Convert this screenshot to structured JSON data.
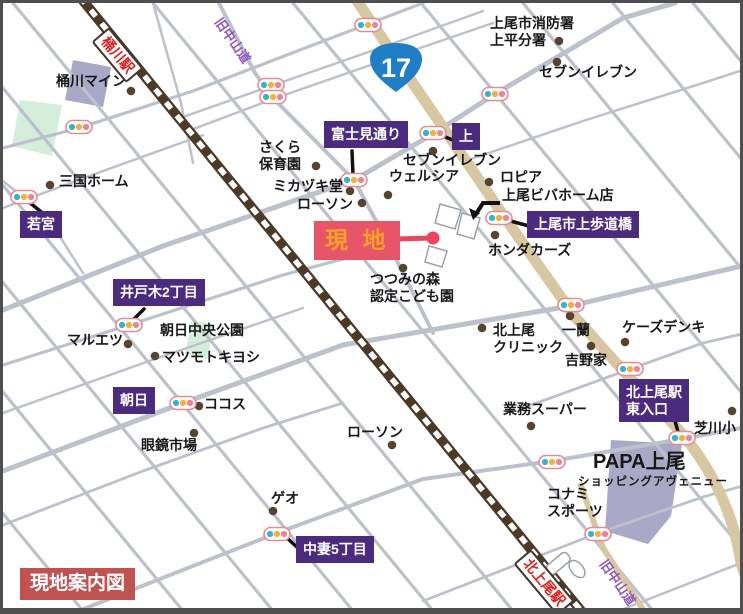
{
  "map": {
    "title_legend": "現地案内図",
    "route_shield": {
      "number": "17",
      "color": "#1f7ec5"
    },
    "colors": {
      "road": "#bcc1cc",
      "route17": "#d8c7a3",
      "railway": "#4d3a26",
      "purple_box": "#4a2b7e",
      "site_box": "#e85468",
      "site_text": "#f6a226",
      "legend_box": "#c05252",
      "station_text": "#dd1f1f",
      "road_name_text": "#8f55c0",
      "park": "#d4eedb",
      "building": "#a9a8c6",
      "poi_dot": "#564430",
      "signal_teal": "#35b5c9",
      "signal_yellow": "#f2b13a",
      "signal_red": "#ef8391"
    },
    "labels": [
      {
        "name": "okegawa-mine",
        "type": "poi",
        "x": 53,
        "y": 70,
        "text": "桶川マイン"
      },
      {
        "name": "mikuni-home",
        "type": "poi",
        "x": 56,
        "y": 170,
        "text": "三国ホーム"
      },
      {
        "name": "ageo-fire-station",
        "type": "poi",
        "x": 487,
        "y": 12,
        "text": "上尾市消防署\n上平分署"
      },
      {
        "name": "seven-eleven-northeast",
        "type": "poi",
        "x": 536,
        "y": 61,
        "text": "セブンイレブン"
      },
      {
        "name": "lopia",
        "type": "poi",
        "x": 497,
        "y": 166,
        "text": "ロピア"
      },
      {
        "name": "ageo-viva-home",
        "type": "poi",
        "x": 499,
        "y": 184,
        "text": "上尾ビバホーム店"
      },
      {
        "name": "sakura-hoikuen",
        "type": "poi",
        "x": 256,
        "y": 136,
        "text": "さくら\n保育園"
      },
      {
        "name": "mikazuki-do",
        "type": "poi",
        "x": 270,
        "y": 175,
        "text": "ミカヅキ堂"
      },
      {
        "name": "lawson-center",
        "type": "poi",
        "x": 294,
        "y": 193,
        "text": "ローソン"
      },
      {
        "name": "welcia",
        "type": "poi",
        "x": 386,
        "y": 165,
        "text": "ウェルシア"
      },
      {
        "name": "seven-eleven-center",
        "type": "poi",
        "x": 400,
        "y": 149,
        "text": "セブンイレブン"
      },
      {
        "name": "honda-cars",
        "type": "poi",
        "x": 485,
        "y": 239,
        "text": "ホンダカーズ"
      },
      {
        "name": "tsutsumi-kodomoen",
        "type": "poi",
        "x": 367,
        "y": 268,
        "text": "つつみの森\n認定こども園"
      },
      {
        "name": "kitaageo-clinic",
        "type": "poi",
        "x": 490,
        "y": 319,
        "text": "北上尾\nクリニック"
      },
      {
        "name": "ichiran",
        "type": "poi",
        "x": 559,
        "y": 319,
        "text": "一蘭"
      },
      {
        "name": "yoshinoya",
        "type": "poi",
        "x": 562,
        "y": 349,
        "text": "吉野家"
      },
      {
        "name": "ks-denki",
        "type": "poi",
        "x": 619,
        "y": 316,
        "text": "ケーズデンキ"
      },
      {
        "name": "gyomu-super",
        "type": "poi",
        "x": 500,
        "y": 398,
        "text": "業務スーパー"
      },
      {
        "name": "shibakawa-elementary",
        "type": "poi",
        "x": 691,
        "y": 417,
        "text": "芝川小"
      },
      {
        "name": "konami-sports",
        "type": "poi",
        "x": 544,
        "y": 483,
        "text": "コナミ\nスポーツ"
      },
      {
        "name": "maruetsu",
        "type": "poi",
        "x": 64,
        "y": 329,
        "text": "マルエツ"
      },
      {
        "name": "asahi-chuo-park",
        "type": "poi",
        "x": 157,
        "y": 319,
        "text": "朝日中央公園"
      },
      {
        "name": "matsumoto-kiyoshi",
        "type": "poi",
        "x": 159,
        "y": 346,
        "text": "マツモトキヨシ"
      },
      {
        "name": "cocos",
        "type": "poi",
        "x": 201,
        "y": 393,
        "text": "ココス"
      },
      {
        "name": "megane-ichiba",
        "type": "poi",
        "x": 138,
        "y": 434,
        "text": "眼鏡市場"
      },
      {
        "name": "lawson-south",
        "type": "poi",
        "x": 344,
        "y": 421,
        "text": "ローソン"
      },
      {
        "name": "geo",
        "type": "poi",
        "x": 268,
        "y": 487,
        "text": "ゲオ"
      },
      {
        "name": "papa-ageo",
        "type": "poi-large",
        "x": 590,
        "y": 448,
        "text": "PAPA上尾"
      },
      {
        "name": "papa-ageo-sub",
        "type": "poi-small",
        "x": 575,
        "y": 473,
        "text": "ショッピングアヴェニュー"
      },
      {
        "name": "wakamiya-signal",
        "type": "box-purple",
        "x": 17,
        "y": 208,
        "text": "若宮"
      },
      {
        "name": "fujimi-dori",
        "type": "box-purple",
        "x": 321,
        "y": 118,
        "text": "富士見通り"
      },
      {
        "name": "kami-signal",
        "type": "box-purple",
        "x": 449,
        "y": 120,
        "text": "上"
      },
      {
        "name": "ageo-hodokyo",
        "type": "box-purple",
        "x": 524,
        "y": 208,
        "text": "上尾市上歩道橋"
      },
      {
        "name": "idoki-2chome",
        "type": "box-purple",
        "x": 110,
        "y": 276,
        "text": "井戸木2丁目"
      },
      {
        "name": "asahi-signal",
        "type": "box-purple",
        "x": 110,
        "y": 384,
        "text": "朝日"
      },
      {
        "name": "nakazuma-5chome",
        "type": "box-purple",
        "x": 293,
        "y": 533,
        "text": "中妻5丁目"
      },
      {
        "name": "kitaageo-east-entrance",
        "type": "box-purple",
        "x": 616,
        "y": 376,
        "text": "北上尾駅\n東入口"
      },
      {
        "name": "site-marker-box",
        "type": "box-site",
        "x": 311,
        "y": 218,
        "text": "現 地"
      },
      {
        "name": "legend",
        "type": "box-legend",
        "x": 17,
        "y": 565,
        "text": "現地案内図"
      },
      {
        "name": "okegawa-station",
        "type": "station",
        "x": 106,
        "y": 24,
        "rot": 50,
        "text": "桶川駅"
      },
      {
        "name": "kitaageo-station",
        "type": "station",
        "x": 528,
        "y": 546,
        "rot": 50,
        "text": "北上尾駅"
      },
      {
        "name": "kyu-nakasendo-north",
        "type": "road-name",
        "x": 221,
        "y": 12,
        "rot": 55,
        "text": "旧中山道"
      },
      {
        "name": "kyu-nakasendo-south",
        "type": "road-name",
        "x": 606,
        "y": 554,
        "rot": 55,
        "text": "旧中山道"
      }
    ],
    "signals": [
      {
        "x": 76,
        "y": 124
      },
      {
        "x": 21,
        "y": 194
      },
      {
        "x": 268,
        "y": 82
      },
      {
        "x": 270,
        "y": 94
      },
      {
        "x": 365,
        "y": 22
      },
      {
        "x": 351,
        "y": 177
      },
      {
        "x": 430,
        "y": 130
      },
      {
        "x": 492,
        "y": 91
      },
      {
        "x": 496,
        "y": 215
      },
      {
        "x": 568,
        "y": 302
      },
      {
        "x": 627,
        "y": 366
      },
      {
        "x": 126,
        "y": 322
      },
      {
        "x": 180,
        "y": 400
      },
      {
        "x": 274,
        "y": 531
      },
      {
        "x": 549,
        "y": 459
      },
      {
        "x": 595,
        "y": 531
      },
      {
        "x": 679,
        "y": 435
      }
    ],
    "poi_dots": [
      [
        47,
        182
      ],
      [
        128,
        88
      ],
      [
        554,
        59
      ],
      [
        556,
        38
      ],
      [
        486,
        179
      ],
      [
        492,
        232
      ],
      [
        430,
        148
      ],
      [
        313,
        163
      ],
      [
        347,
        188
      ],
      [
        359,
        200
      ],
      [
        385,
        192
      ],
      [
        400,
        265
      ],
      [
        479,
        325
      ],
      [
        567,
        313
      ],
      [
        588,
        343
      ],
      [
        622,
        339
      ],
      [
        528,
        423
      ],
      [
        729,
        408
      ],
      [
        125,
        341
      ],
      [
        152,
        353
      ],
      [
        196,
        403
      ],
      [
        191,
        430
      ],
      [
        389,
        442
      ],
      [
        270,
        508
      ]
    ],
    "connector_lines": [
      {
        "x1": 26,
        "y1": 199,
        "x2": 42,
        "y2": 212
      },
      {
        "x1": 349,
        "y1": 148,
        "x2": 350,
        "y2": 172
      },
      {
        "x1": 440,
        "y1": 133,
        "x2": 452,
        "y2": 138
      },
      {
        "x1": 504,
        "y1": 217,
        "x2": 526,
        "y2": 223
      },
      {
        "x1": 141,
        "y1": 306,
        "x2": 129,
        "y2": 318
      },
      {
        "x1": 283,
        "y1": 534,
        "x2": 297,
        "y2": 547
      },
      {
        "x1": 672,
        "y1": 418,
        "x2": 676,
        "y2": 432
      }
    ],
    "site_marker": {
      "dot_x": 430,
      "dot_y": 235,
      "line_x1": 393,
      "line_y1": 236,
      "color": "#e8475e"
    }
  }
}
